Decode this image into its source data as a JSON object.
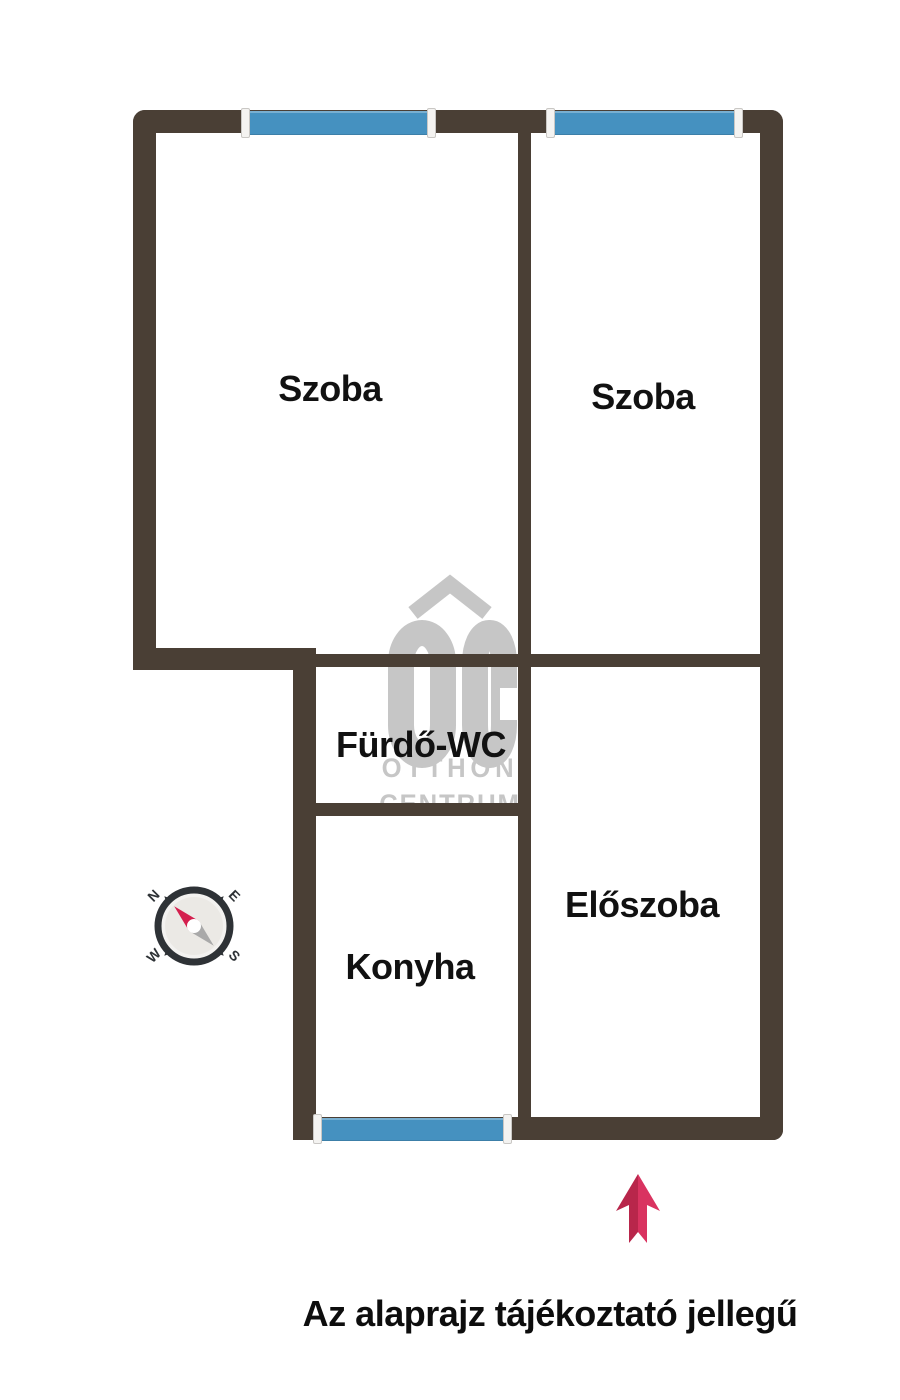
{
  "colors": {
    "background": "#ffffff",
    "wall": "#4a3f35",
    "window": "#4591c0",
    "window_trim": "#f4f3f1",
    "watermark": "#c6c6c6",
    "label": "#111111",
    "arrow_dark": "#b8264b",
    "arrow_light": "#d93360",
    "compass_dark": "#2e3236",
    "compass_face": "#f3f2f0",
    "needle_red": "#d41f4e",
    "needle_gray": "#a9a9a9"
  },
  "rooms": {
    "szoba1": {
      "label": "Szoba"
    },
    "szoba2": {
      "label": "Szoba"
    },
    "furdo_wc": {
      "label": "Fürdő-WC"
    },
    "konyha": {
      "label": "Konyha"
    },
    "eloszoba": {
      "label": "Előszoba"
    }
  },
  "watermark": {
    "logo": "ÓC",
    "line1": "OTTHON",
    "line2": "CENTRUM"
  },
  "compass": {
    "north": "N",
    "east": "E",
    "west": "W",
    "south": "S"
  },
  "disclaimer": "Az alaprajz tájékoztató jellegű"
}
